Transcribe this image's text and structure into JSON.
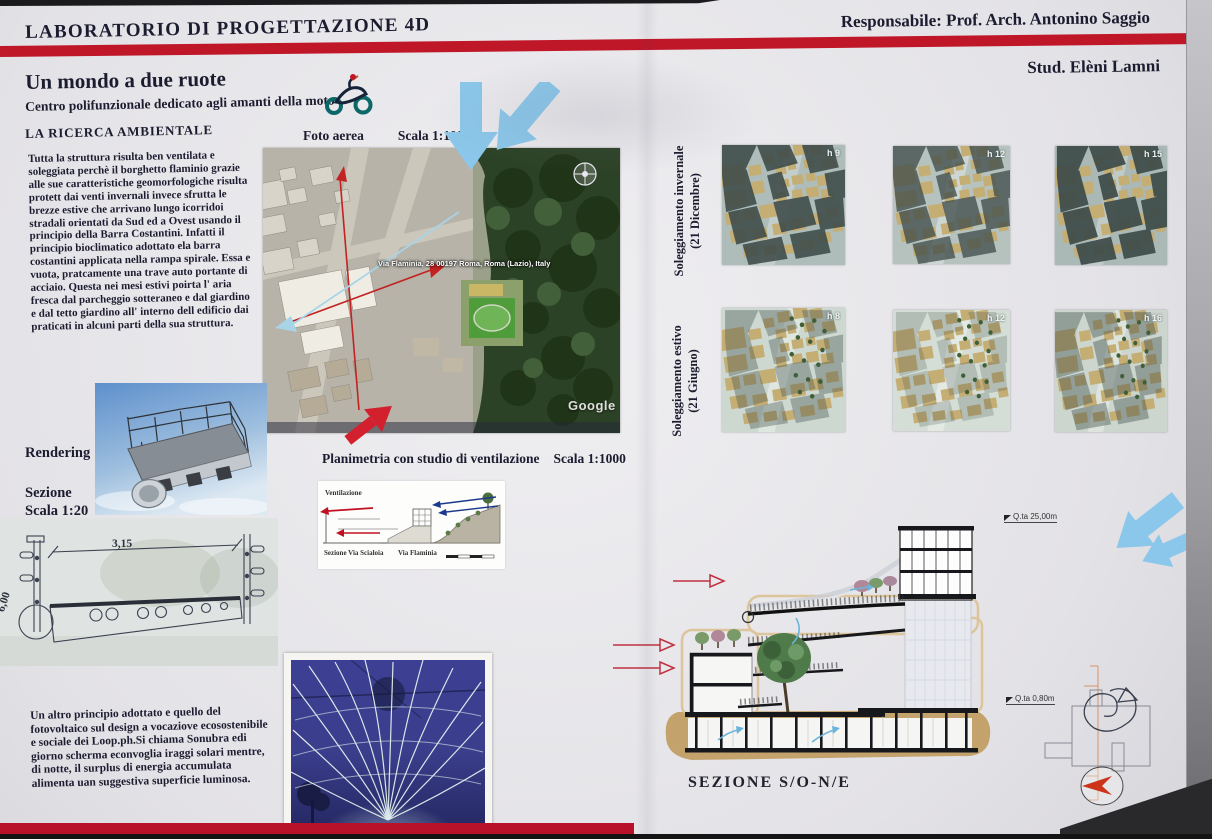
{
  "header": {
    "lab_title": "LABORATORIO DI PROGETTAZIONE 4D",
    "responsabile": "Responsabile: Prof. Arch. Antonino Saggio",
    "student": "Stud. Elèni Lamni"
  },
  "intro": {
    "title": "Un mondo a due ruote",
    "subtitle": "Centro polifunzionale dedicato agli amanti della moto",
    "heading": "LA RICERCA AMBIENTALE",
    "body": "Tutta la struttura risulta ben ventilata e soleggiata perchè il borghetto flaminio grazie alle sue caratteristiche geomorfologiche risulta protett dai venti invernali invece sfrutta le brezze estive che arrivano lungo icorridoi stradali orientati da Sud ed a Ovest usando il principio della Barra Costantini. Infatti il principio bioclimatico adottato ela barra costantini applicata nella rampa spirale. Essa e vuota, pratcamente una trave auto portante di acciaio. Questa nei mesi estivi poirta l' aria fresca dal parcheggio sotteraneo e dal giardino e dal tetto giardino all' interno dell edificio dai praticati in alcuni parti della sua struttura."
  },
  "photovoltaic": {
    "body": "Un altro principio adottato e quello del fotovoltaico sul design a vocaziove ecosostenibile e sociale  dei Loop.ph.Si chiama Sonubra edi giorno scherma econvoglia iraggi solari mentre, di notte, il surplus di energia accumulata alimenta uan suggestiva superficie luminosa."
  },
  "aerial": {
    "label": "Foto aerea",
    "scale": "Scala 1:1000",
    "address": "Via Flaminia, 28 00197 Roma, Roma (Lazio), Italy",
    "watermark": "Google"
  },
  "sun": {
    "winter_label": "Soleggiamento invernale",
    "winter_date": "(21 Dicembre)",
    "summer_label": "Soleggiamento estivo",
    "summer_date": "(21 Giugno)",
    "winter_hours": [
      "h 9",
      "h 12",
      "h 15"
    ],
    "summer_hours": [
      "h 8",
      "h 12",
      "h 16"
    ]
  },
  "left_panel": {
    "rendering_label": "Rendering",
    "sezione_label": "Sezione",
    "sezione_scale": "Scala 1:20",
    "dim_width": "3,15",
    "dim_height": "6,00"
  },
  "ventilation": {
    "title": "Planimetria con studio di ventilazione",
    "scale": "Scala 1:1000",
    "diagram_label": "Ventilazione",
    "street_left": "Sezione Via Scialoia",
    "street_right": "Via Flaminia"
  },
  "section_big": {
    "title": "SEZIONE  S/O-N/E",
    "quota_top": "Q.ta 25,00m",
    "quota_bottom": "Q.ta 0,80m"
  },
  "colors": {
    "stripe_red": "#bf1628",
    "arrow_blue": "#8bc7ea",
    "arrow_red": "#d3202e",
    "building_tan": "#c5ae74",
    "shadow_slate": "#3d4b49"
  }
}
